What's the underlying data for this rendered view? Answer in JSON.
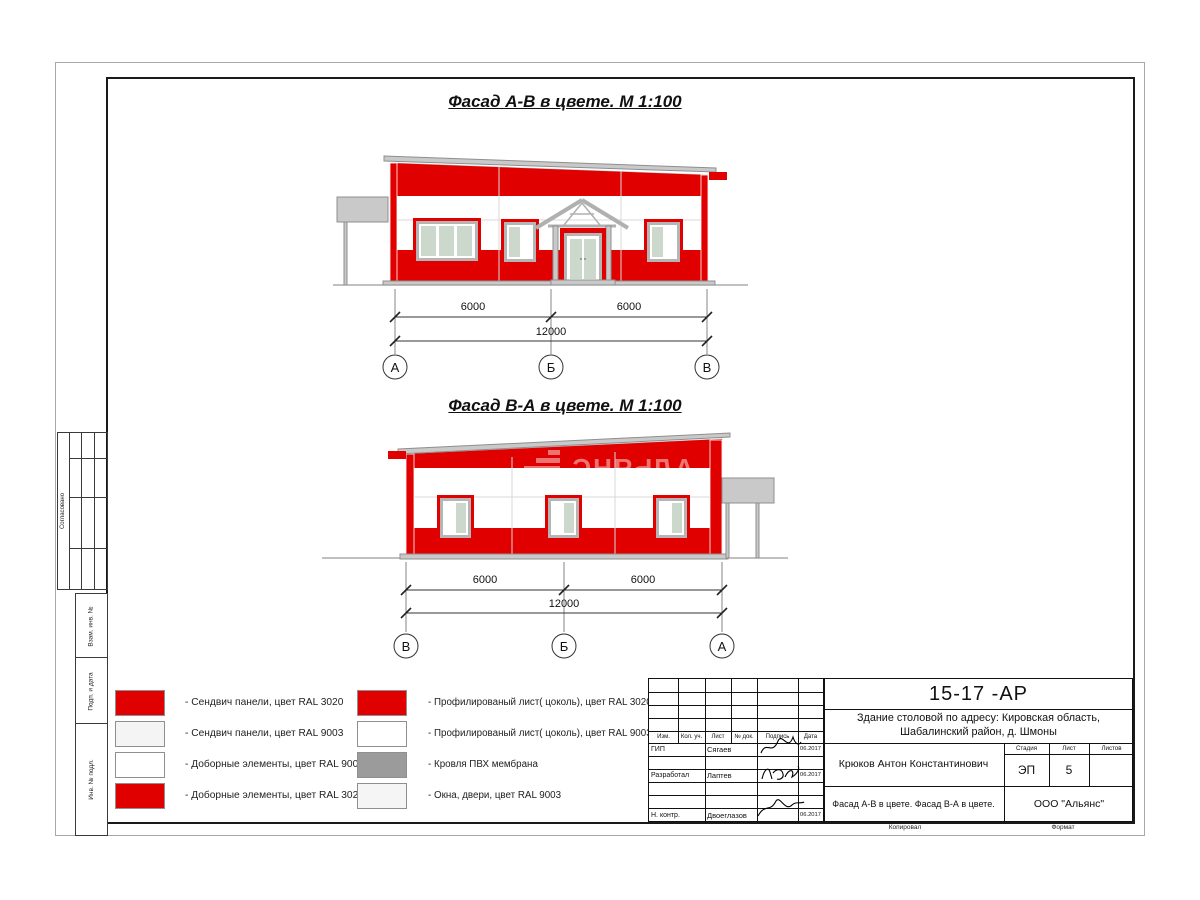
{
  "colors": {
    "panel_red": "#e10000",
    "roof_gray": "#c9c9c9",
    "frame_gray": "#b5b5b5",
    "glass_green": "#ccd8cc"
  },
  "titles": {
    "facade_ab": "Фасад А-В в цвете.  М 1:100",
    "facade_ba": "Фасад В-А в цвете.  М 1:100"
  },
  "watermark": "АЛЬЯНС",
  "facade_ab": {
    "axes": [
      "А",
      "Б",
      "В"
    ],
    "dims": {
      "span1": "6000",
      "span2": "6000",
      "total": "12000"
    }
  },
  "facade_ba": {
    "axes": [
      "В",
      "Б",
      "А"
    ],
    "dims": {
      "span1": "6000",
      "span2": "6000",
      "total": "12000"
    }
  },
  "legend": {
    "left": [
      {
        "color": "#e10000",
        "label": "- Сендвич панели, цвет RAL 3020"
      },
      {
        "color": "#f4f4f4",
        "label": "- Сендвич панели, цвет RAL 9003"
      },
      {
        "color": "#ffffff",
        "label": "- Доборные элементы, цвет RAL 9003"
      },
      {
        "color": "#e10000",
        "label": "- Доборные элементы, цвет RAL 3020"
      }
    ],
    "right": [
      {
        "color": "#e10000",
        "label": "- Профилированый лист( цоколь), цвет RAL 3020"
      },
      {
        "color": "#ffffff",
        "label": "- Профилированый лист( цоколь), цвет RAL 9003"
      },
      {
        "color": "#9b9b9b",
        "label": "- Кровля ПВХ мембрана"
      },
      {
        "color": "#f5f5f5",
        "label": "- Окна, двери, цвет RAL 9003"
      }
    ]
  },
  "sidebar": {
    "agreed": "Согласовано",
    "cells": [
      "Взам. инв. №",
      "Подп. и дата",
      "Инв. № подл."
    ]
  },
  "titleblock": {
    "doc_number": "15-17 -АР",
    "project_line1": "Здание столовой по адресу: Кировская область,",
    "project_line2": "Шабалинский район, д. Шмоны",
    "chief_name": "Крюков Антон Константинович",
    "stage_value": "ЭП",
    "sheet_value": "5",
    "sheets_value": "",
    "sheet_title": "Фасад А-В в цвете. Фасад В-А в цвете.",
    "company": "ООО \"Альянс\"",
    "headers": {
      "izm": "Изм.",
      "kol": "Кол. уч.",
      "list": "Лист",
      "doc": "№ док.",
      "sign": "Подпись",
      "date": "Дата",
      "stage": "Стадия",
      "sheet": "Лист",
      "sheets": "Листов"
    },
    "rows": [
      {
        "role": "ГИП",
        "name": "Сягаев",
        "date": "06.2017"
      },
      {
        "role": "Разработал",
        "name": "Лаптев",
        "date": "06.2017"
      },
      {
        "role": "Н. контр.",
        "name": "Двоеглазов",
        "date": "06.2017"
      }
    ],
    "footer": {
      "copied": "Копировал",
      "format": "Формат"
    }
  }
}
